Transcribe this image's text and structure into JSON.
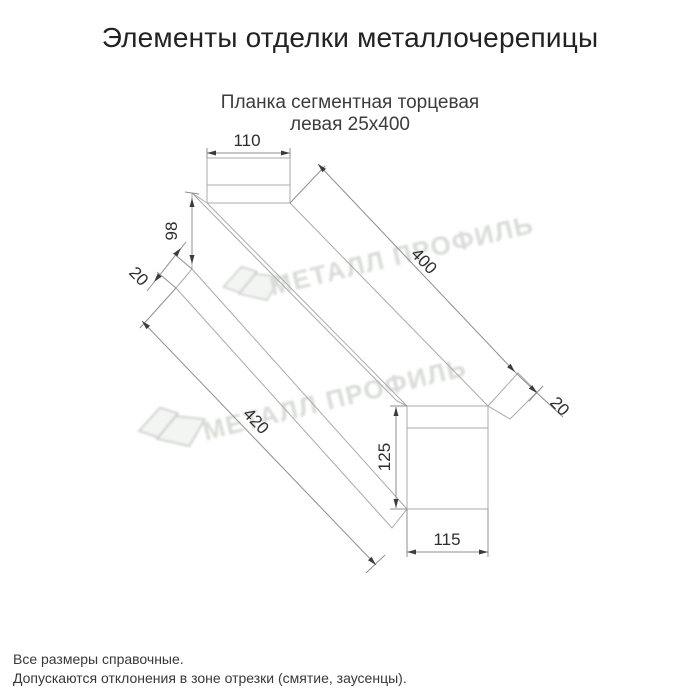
{
  "page": {
    "title": "Элементы отделки металлочерепицы"
  },
  "drawing": {
    "subtitle_line1": "Планка сегментная торцевая",
    "subtitle_line2": "левая 25х400",
    "dimensions": {
      "top_tab_width": "110",
      "left_end_height": "98",
      "left_flap": "20",
      "top_length": "400",
      "bottom_length": "420",
      "right_flap": "20",
      "end_height": "125",
      "end_width": "115"
    }
  },
  "watermark": {
    "text": "МЕТАЛЛ ПРОФИЛЬ",
    "color": "#d8dcd6"
  },
  "colors": {
    "profile_line": "#ababab",
    "dimension_line": "#8f8f8f",
    "dimension_text": "#2e2e2e",
    "title_text": "#222222"
  },
  "footer": {
    "line1": "Все размеры справочные.",
    "line2": "Допускаются отклонения в зоне отрезки (смятие, заусенцы)."
  }
}
